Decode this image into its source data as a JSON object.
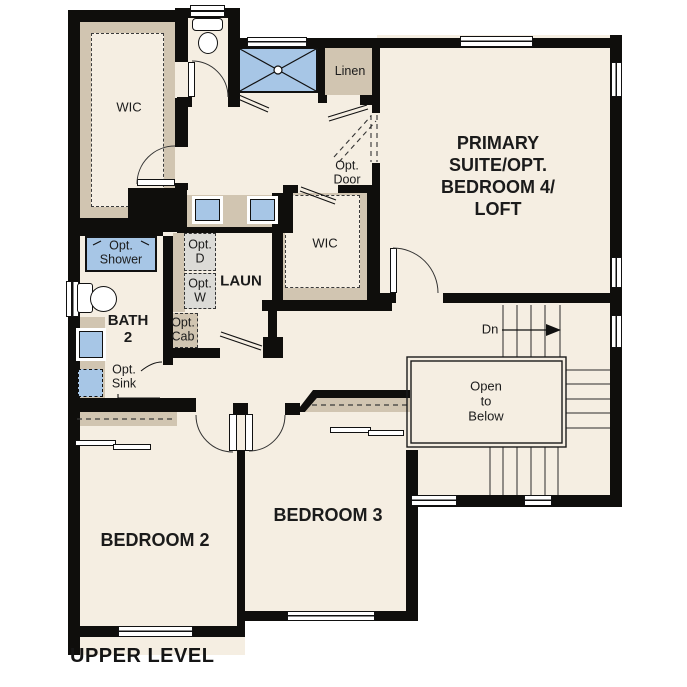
{
  "labels": {
    "wic_primary": "WIC",
    "linen": "Linen",
    "opt_door": "Opt.\nDoor",
    "primary_suite": "PRIMARY\nSUITE/OPT.\nBEDROOM 4/\nLOFT",
    "opt_shower": "Opt.\nShower",
    "opt_dryer": "Opt.\nD",
    "opt_washer": "Opt.\nW",
    "laundry": "LAUN",
    "wic_hall": "WIC",
    "bath2": "BATH\n2",
    "opt_cab": "Opt.\nCab",
    "opt_sink": "Opt.\nSink",
    "down": "Dn",
    "open_to_below": "Open\nto\nBelow",
    "bedroom2": "BEDROOM 2",
    "bedroom3": "BEDROOM 3",
    "title": "UPPER LEVEL"
  },
  "colors": {
    "floor": "#f5eee2",
    "wall": "#0f0e0c",
    "closet_tan": "#d1c5b1",
    "fixture_blue": "#a7c6e6",
    "appliance_gray": "#dcdbd7",
    "window_white": "#ffffff"
  }
}
